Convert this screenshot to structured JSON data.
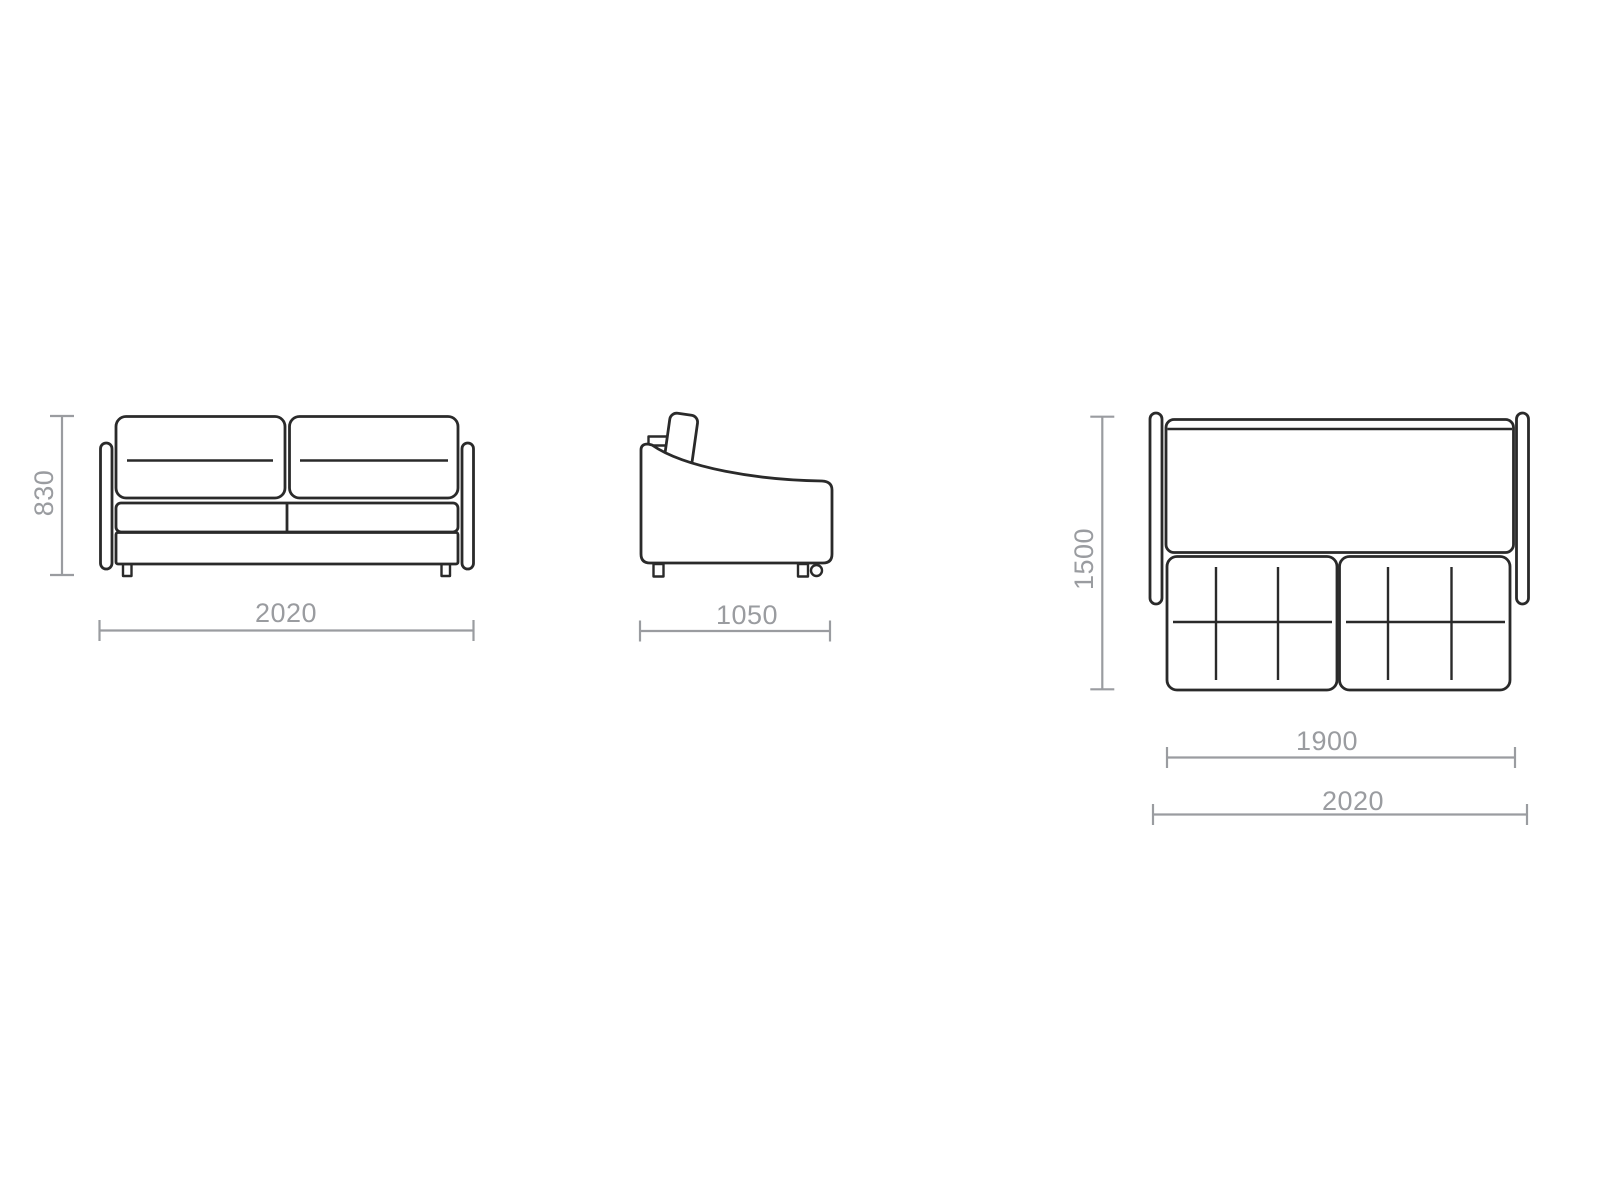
{
  "colors": {
    "outline": "#2a2a2a",
    "dimension": "#9a9ca0"
  },
  "front_view": {
    "height_mm": "830",
    "width_mm": "2020"
  },
  "side_view": {
    "depth_mm": "1050"
  },
  "top_view": {
    "depth_unfolded_mm": "1500",
    "bed_length_mm": "1900",
    "overall_width_mm": "2020"
  }
}
